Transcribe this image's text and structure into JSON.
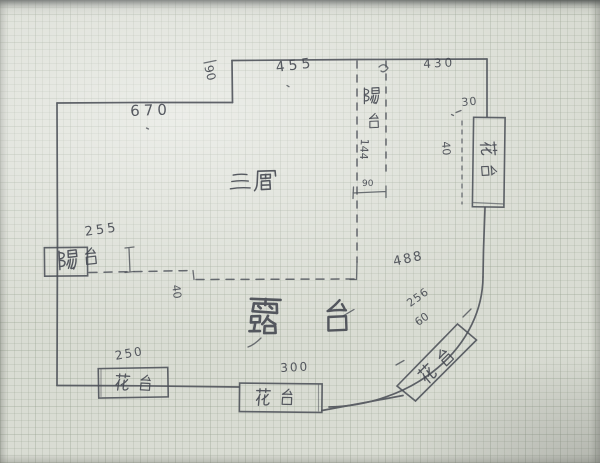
{
  "plan": {
    "areas": [
      {
        "id": "floor",
        "label": "三層"
      },
      {
        "id": "terrace",
        "label": "露台"
      },
      {
        "id": "balcony-top",
        "label": "陽台"
      },
      {
        "id": "balcony-left",
        "label": "陽台"
      },
      {
        "id": "planter-right",
        "label": "花台"
      },
      {
        "id": "planter-bottom-left",
        "label": "花台"
      },
      {
        "id": "planter-bottom-middle",
        "label": "花台"
      },
      {
        "id": "planter-arc",
        "label": "花台"
      }
    ],
    "dimensions": {
      "top_left_wall": "670",
      "top_left_step": "90",
      "top_wall_left": "455",
      "top_wall_right": "430",
      "right_step": "30",
      "right_planter_depth": "40",
      "top_balcony_length": "144",
      "top_balcony_width": "90",
      "left_balcony_width": "255",
      "terrace_edge_step": "40",
      "terrace_right": "488",
      "planter_bottom_left_width": "250",
      "planter_bottom_middle_width": "300",
      "arc_planter_length": "256",
      "arc_planter_depth": "60"
    }
  }
}
